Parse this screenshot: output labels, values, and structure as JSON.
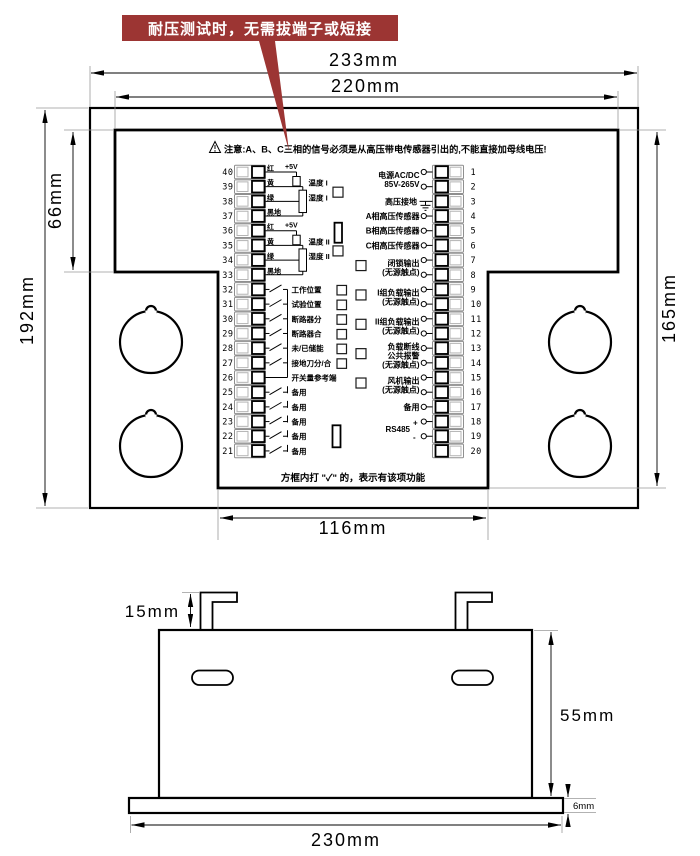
{
  "banner": {
    "text": "耐压测试时，无需拔端子或短接",
    "color": "#9c3533"
  },
  "warning": "注意:A、B、C三相的信号必须是从高压带电传感器引出的,不能直接加母线电压!",
  "bottom_note": "方框内打 \"✓\" 的，表示有该项功能",
  "dimensions": {
    "outer_width": "233mm",
    "inner_width": "220mm",
    "outer_height": "192mm",
    "top_band_height": "66mm",
    "inner_height": "165mm",
    "column_width": "116mm",
    "hook_height": "15mm",
    "body_height": "55mm",
    "flange_thickness": "6mm",
    "flange_width": "230mm"
  },
  "left_strip": {
    "numbers": [
      40,
      39,
      38,
      37,
      36,
      35,
      34,
      33,
      32,
      31,
      30,
      29,
      28,
      27,
      26,
      25,
      24,
      23,
      22,
      21
    ],
    "sensor_groups": [
      {
        "wire_labels": [
          "红",
          "黄",
          "绿",
          "黑地"
        ],
        "supply": "+5V",
        "rows": [
          "温度 I",
          "湿度 I"
        ]
      },
      {
        "wire_labels": [
          "红",
          "黄",
          "绿",
          "黑地"
        ],
        "supply": "+5V",
        "rows": [
          "温度 II",
          "湿度 II"
        ]
      }
    ],
    "switch_rows": [
      {
        "label": "工作位置",
        "checkbox": true
      },
      {
        "label": "试验位置",
        "checkbox": true
      },
      {
        "label": "断路器分",
        "checkbox": true
      },
      {
        "label": "断路器合",
        "checkbox": true
      },
      {
        "label": "未/已储能",
        "checkbox": true
      },
      {
        "label": "接地刀分/合",
        "checkbox": true
      },
      {
        "label": "开关量参考端",
        "checkbox": false,
        "no_switch": true
      },
      {
        "label": "备用",
        "checkbox": false
      },
      {
        "label": "备用",
        "checkbox": false
      },
      {
        "label": "备用",
        "checkbox": false
      },
      {
        "label": "备用",
        "checkbox": false
      },
      {
        "label": "备用",
        "checkbox": false
      }
    ]
  },
  "right_strip": {
    "numbers": [
      1,
      2,
      3,
      4,
      5,
      6,
      7,
      8,
      9,
      10,
      11,
      12,
      13,
      14,
      15,
      16,
      17,
      18,
      19,
      20
    ],
    "groups": [
      {
        "lines": [
          "电源AC/DC",
          "85V-265V"
        ],
        "rows": [
          1,
          2
        ]
      },
      {
        "lines": [
          "高压接地"
        ],
        "rows": [
          3
        ],
        "ground": true
      },
      {
        "lines": [
          "A相高压传感器"
        ],
        "rows": [
          4
        ]
      },
      {
        "lines": [
          "B相高压传感器"
        ],
        "rows": [
          5
        ],
        "jumper": true
      },
      {
        "lines": [
          "C相高压传感器"
        ],
        "rows": [
          6
        ]
      },
      {
        "lines": [
          "闭锁输出",
          "(无源触点)"
        ],
        "rows": [
          7,
          8
        ],
        "checkbox": true
      },
      {
        "lines": [
          "I组负载输出",
          "(无源触点)"
        ],
        "rows": [
          9,
          10
        ],
        "checkbox": true
      },
      {
        "lines": [
          "II组负载输出",
          "(无源触点)"
        ],
        "rows": [
          11,
          12
        ],
        "checkbox": true
      },
      {
        "lines": [
          "负载断线",
          "公共报警",
          "(无源触点)"
        ],
        "rows": [
          13,
          14
        ],
        "checkbox": true
      },
      {
        "lines": [
          "风机输出",
          "(无源触点)"
        ],
        "rows": [
          15,
          16
        ],
        "checkbox": true
      },
      {
        "lines": [
          "备用"
        ],
        "rows": [
          17
        ]
      },
      {
        "lines": [
          "RS485"
        ],
        "rows": [
          18,
          19
        ],
        "plusminus": true,
        "plus": "+",
        "minus": "-",
        "jumper": true
      }
    ]
  }
}
